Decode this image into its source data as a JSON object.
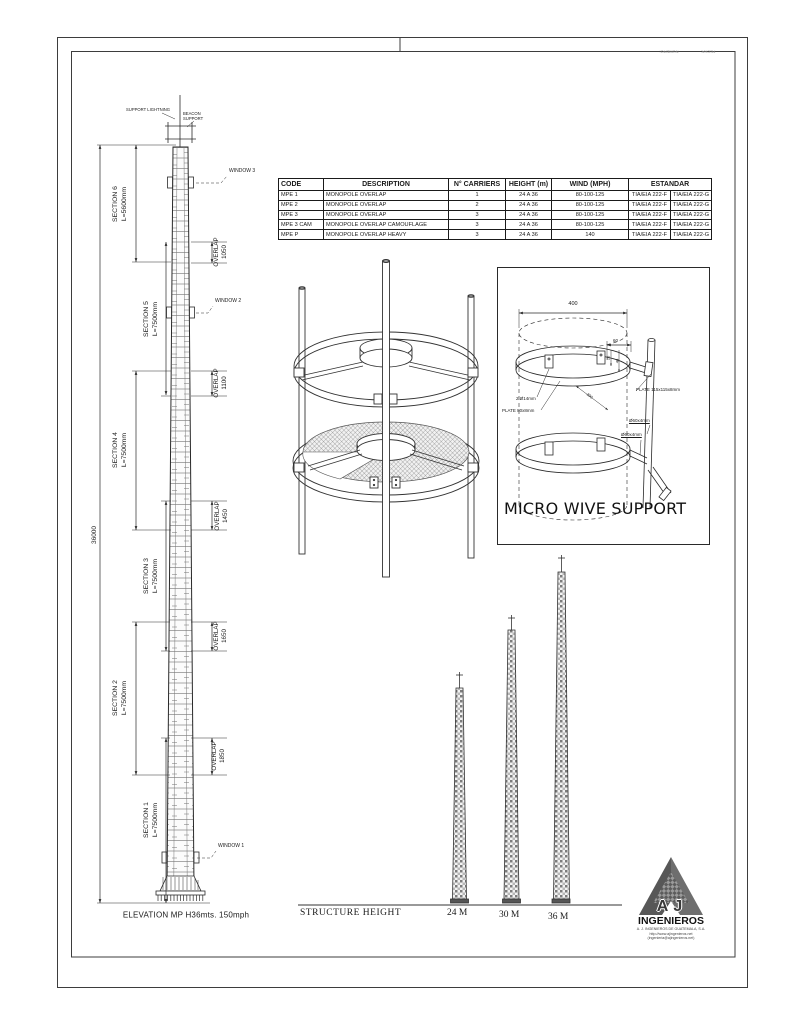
{
  "sheet": {
    "stamp_left": "NUMERO:",
    "stamp_right": "FECHA:"
  },
  "elevation": {
    "caption": "ELEVATION MP H36mts. 150mph",
    "overall_dim": "36000",
    "support_lightning": "SUPPORT LIGHTNING",
    "beacon_support": "BEACON SUPPORT",
    "sections": [
      {
        "name": "SECTION 6",
        "length": "L=5600mm"
      },
      {
        "name": "SECTION 5",
        "length": "L=7500mm"
      },
      {
        "name": "SECTION 4",
        "length": "L=7500mm"
      },
      {
        "name": "SECTION 3",
        "length": "L=7500mm"
      },
      {
        "name": "SECTION 2",
        "length": "L=7500mm"
      },
      {
        "name": "SECTION 1",
        "length": "L=7500mm"
      }
    ],
    "overlaps": [
      {
        "name": "OVERLAP",
        "value": "1050"
      },
      {
        "name": "OVERLAP",
        "value": "1100"
      },
      {
        "name": "OVERLAP",
        "value": "1450"
      },
      {
        "name": "OVERLAP",
        "value": "1650"
      },
      {
        "name": "OVERLAP",
        "value": "1850"
      }
    ],
    "windows": [
      "WINDOW 3",
      "WINDOW 2",
      "WINDOW 1"
    ]
  },
  "spec_table": {
    "headers": [
      "CODE",
      "DESCRIPTION",
      "N° CARRIERS",
      "HEIGHT (m)",
      "WIND (MPH)",
      "ESTANDAR"
    ],
    "rows": [
      [
        "MPE 1",
        "MONOPOLE OVERLAP",
        "1",
        "24 A 36",
        "80-100-125",
        "TIA/EIA 222-F",
        "TIA/EIA 222-G"
      ],
      [
        "MPE 2",
        "MONOPOLE OVERLAP",
        "2",
        "24 A 36",
        "80-100-125",
        "TIA/EIA 222-F",
        "TIA/EIA 222-G"
      ],
      [
        "MPE 3",
        "MONOPOLE OVERLAP",
        "3",
        "24 A 36",
        "80-100-125",
        "TIA/EIA 222-F",
        "TIA/EIA 222-G"
      ],
      [
        "MPE 3 CAM",
        "MONOPOLE OVERLAP CAMOUFLAGE",
        "3",
        "24 A 36",
        "80-100-125",
        "TIA/EIA 222-F",
        "TIA/EIA 222-G"
      ],
      [
        "MPE P",
        "MONOPOLE OVERLAP HEAVY",
        "3",
        "24 A 36",
        "140",
        "TIA/EIA 222-F",
        "TIA/EIA 222-G"
      ]
    ]
  },
  "micro_support": {
    "title": "MICRO WIVE SUPPORT",
    "dim_width": "400",
    "dim_offset": "60",
    "dim_a": "20",
    "dim_b": "40",
    "dim_c": "300",
    "label_bolts": "2 Ø14mm",
    "label_band_plate": "PLATE 80x8mm",
    "label_plate": "PLATE 115x115x8mm",
    "label_pipe_upper": "Ø60x4mm",
    "label_pipe_lower": "Ø60x4mm"
  },
  "structure_height": {
    "title": "STRUCTURE HEIGHT",
    "heights": [
      "24 M",
      "30 M",
      "36 M"
    ]
  },
  "logo": {
    "monogram": "AJ",
    "company": "INGENIEROS",
    "address1": "A. J. INGENIEROS DE GUATEMALA, S.A.",
    "address2": "http://www.ajingenieros.net",
    "address3": "(ingenieria@ajingenieros.net)"
  }
}
